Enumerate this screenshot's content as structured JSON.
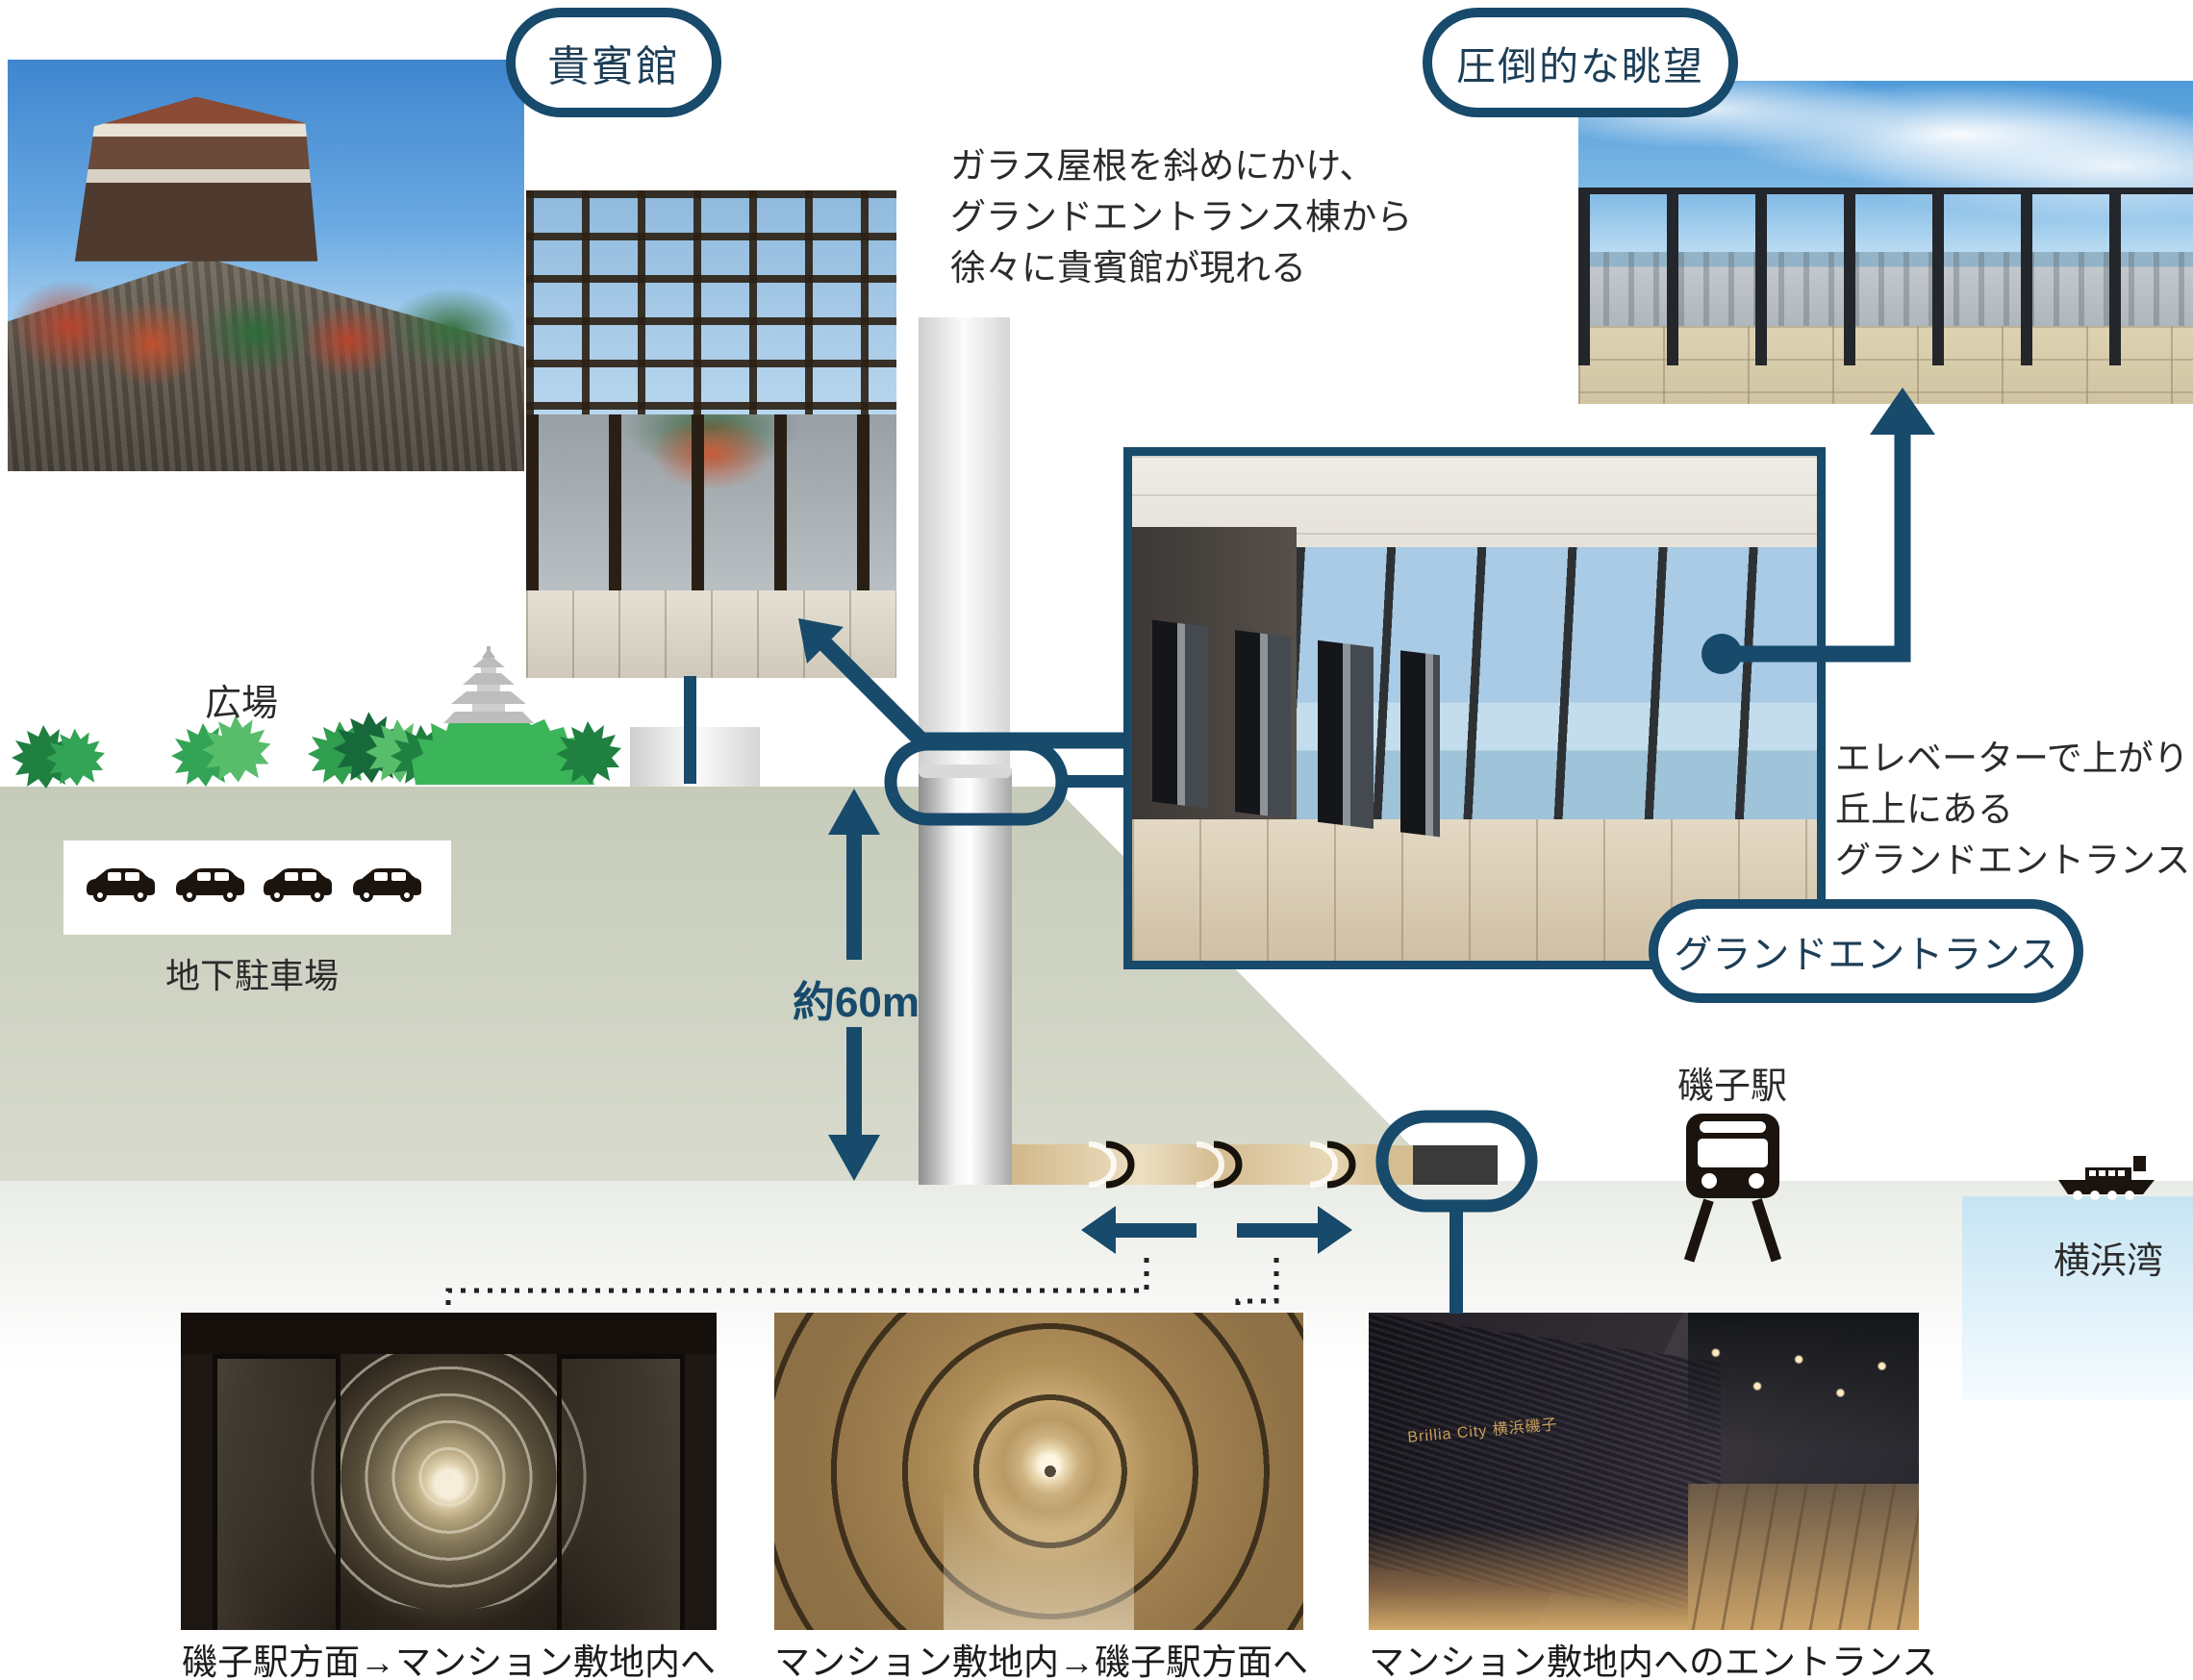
{
  "colors": {
    "navy": "#174a6b",
    "pill_text": "#1d3e57",
    "hill_ground": "#c8cdbc",
    "lower_ground": "#e9ece6",
    "sea": "#c6e4f3",
    "tunnel": "#d5bd92",
    "body_text": "#2b2b2b"
  },
  "pills": {
    "kihinkan": "貴賓館",
    "view": "圧倒的な眺望",
    "grand_entrance": "グランドエントランス"
  },
  "annotations": {
    "canopy": {
      "line1": "ガラス屋根を斜めにかけ、",
      "line2": "グランドエントランス棟から",
      "line3": "徐々に貴賓館が現れる"
    },
    "elevator": {
      "line1": "エレベーターで上がり",
      "line2": "丘上にある",
      "line3": "グランドエントランス"
    }
  },
  "labels": {
    "plaza": "広場",
    "underground_parking": "地下駐車場",
    "elevator_height": "約60m",
    "station": "磯子駅",
    "bay": "横浜湾"
  },
  "captions": {
    "tunnel_from_station": "磯子駅方面→マンション敷地内へ",
    "tunnel_to_station": "マンション敷地内→磯子駅方面へ",
    "site_entrance": "マンション敷地内へのエントランス"
  },
  "photo_details": {
    "entrance_sign": "Brillia City 横浜磯子"
  },
  "icons": {
    "train": "train-icon",
    "ship": "ship-icon",
    "car": "car-icon",
    "pagoda": "pagoda-icon",
    "tree": "tree-icon"
  }
}
